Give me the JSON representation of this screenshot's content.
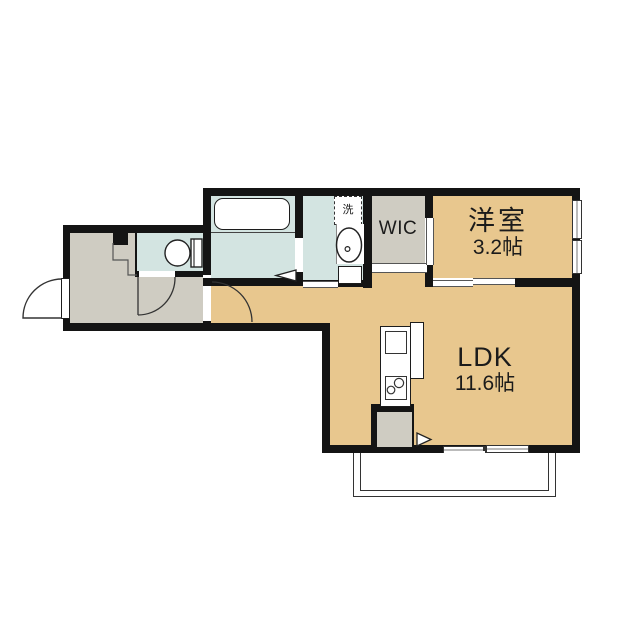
{
  "floorplan": {
    "rooms": {
      "ldk": {
        "name": "LDK",
        "area": "11.6帖"
      },
      "western_room": {
        "name": "洋室",
        "area": "3.2帖"
      },
      "wic": {
        "name": "WIC"
      },
      "laundry": {
        "name": "洗"
      }
    },
    "colors": {
      "wall": "#141414",
      "floor-main": "#e8c78e",
      "floor-wet": "#d3e4e1",
      "floor-gray": "#cfccc2"
    }
  }
}
